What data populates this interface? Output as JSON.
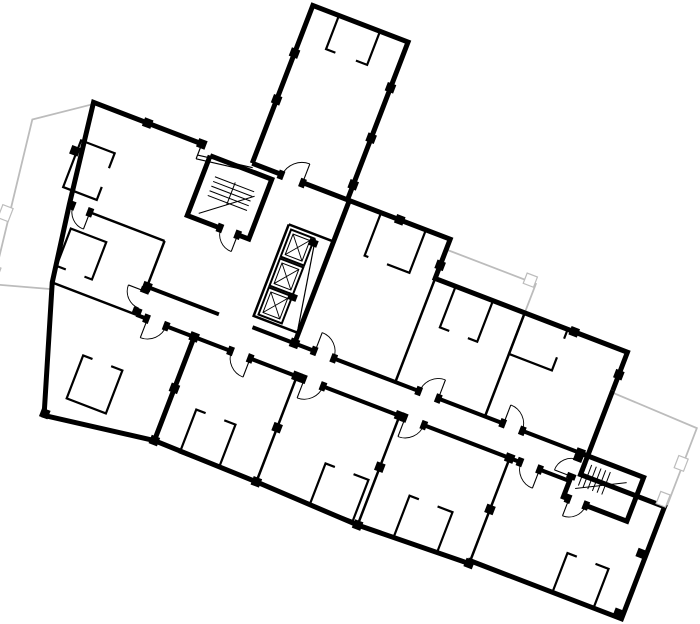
{
  "canvas": {
    "width": 700,
    "height": 624,
    "background": "#ffffff"
  },
  "palette": {
    "wall": "#000000",
    "terrace_line": "#bcbcbc",
    "floor": "#ffffff"
  },
  "plan": {
    "type": "architectural-floor-plan",
    "rotation_deg": 21,
    "stroke_layers": [
      {
        "name": "terrace-outlines",
        "color": "#bcbcbc",
        "width": 1.8,
        "paths": [
          "M124,64 L73,100 L95,268 L150,252",
          "M506,73 L602,73 L602,104",
          "M712,147 L804,150 L804,233 L712,235"
        ]
      },
      {
        "name": "exterior-walls",
        "color": "#000000",
        "width": 5,
        "paths": [
          "M294,62 L294,-107 L396,-107 L396,62",
          "M240,62 L124,62 L138,166 L150,245 L190,372 L302,356 L302,245",
          "M294,62 L396,62",
          "M396,62 L506,62 L506,104 L712,104 L712,145",
          "M302,356 L412,358 L522,362 L640,358 L640,355 L802,355 L802,235 L712,235 L712,145",
          "M398,62 L398,215",
          "M704,215 L772,215 L772,262 L704,262 L704,215",
          "M252,70 L318,70 L318,134 L252,134 L252,70"
        ]
      },
      {
        "name": "corridor-walls",
        "color": "#000000",
        "width": 4,
        "paths": [
          "M240,215 L318,215",
          "M352,215 L704,215",
          "M240,245 L704,245"
        ]
      },
      {
        "name": "partition-walls",
        "color": "#000000",
        "width": 2.5,
        "paths": [
          "M138,166 L240,166",
          "M240,166 L240,245",
          "M506,104 L506,215",
          "M602,104 L602,215",
          "M412,245 L412,358",
          "M522,245 L522,362",
          "M640,245 L640,358",
          "M150,245 L240,245",
          "M712,235 L802,235",
          "M350,106 L398,106",
          "M350,106 L350,204 L398,204"
        ]
      },
      {
        "name": "thin-lines",
        "color": "#000000",
        "width": 1.2,
        "paths": [
          "M240,62 L240,78",
          "M240,74 L296,66",
          "M240,78 L296,70",
          "M380,110 L396,200"
        ]
      }
    ],
    "closets": [
      {
        "rect": [
          126,
          102,
          36,
          50
        ],
        "gap": [
          158,
          118,
          8,
          20
        ]
      },
      {
        "rect": [
          148,
          188,
          38,
          40
        ],
        "gap": [
          158,
          224,
          20,
          8
        ]
      },
      {
        "rect": [
          205,
          302,
          42,
          46
        ],
        "gap": [
          215,
          298,
          20,
          8
        ]
      },
      {
        "rect": [
          322,
          -107,
          44,
          36
        ],
        "gap": [
          332,
          -75,
          22,
          8
        ]
      },
      {
        "rect": [
          432,
          62,
          48,
          46
        ],
        "gap": [
          436,
          104,
          20,
          8
        ]
      },
      {
        "rect": [
          528,
          104,
          40,
          44
        ],
        "gap": [
          538,
          144,
          20,
          8
        ]
      },
      {
        "rect": [
          602,
          104,
          46,
          44
        ],
        "gap": [
          644,
          114,
          8,
          20
        ]
      },
      {
        "rect": [
          330,
          312,
          42,
          46
        ],
        "gap": [
          340,
          308,
          20,
          8
        ]
      },
      {
        "rect": [
          470,
          316,
          46,
          44
        ],
        "gap": [
          480,
          312,
          20,
          8
        ]
      },
      {
        "rect": [
          560,
          316,
          46,
          44
        ],
        "gap": [
          570,
          312,
          20,
          8
        ]
      },
      {
        "rect": [
          728,
          313,
          44,
          42
        ],
        "gap": [
          738,
          309,
          20,
          8
        ]
      }
    ],
    "columns": [
      [
        182,
        62
      ],
      [
        240,
        62
      ],
      [
        294,
        -56
      ],
      [
        294,
        -6
      ],
      [
        396,
        -58
      ],
      [
        396,
        -4
      ],
      [
        396,
        46
      ],
      [
        452,
        62
      ],
      [
        506,
        90
      ],
      [
        655,
        104
      ],
      [
        712,
        128
      ],
      [
        124,
        114
      ],
      [
        190,
        370
      ],
      [
        240,
        215
      ],
      [
        302,
        245
      ],
      [
        302,
        300
      ],
      [
        302,
        356
      ],
      [
        398,
        215
      ],
      [
        412,
        245
      ],
      [
        412,
        300
      ],
      [
        412,
        358
      ],
      [
        522,
        245
      ],
      [
        522,
        300
      ],
      [
        522,
        362
      ],
      [
        640,
        245
      ],
      [
        640,
        300
      ],
      [
        640,
        358
      ],
      [
        704,
        215
      ],
      [
        797,
        287
      ],
      [
        797,
        351
      ]
    ],
    "elevator_shafts": [
      [
        354,
        110,
        25,
        29
      ],
      [
        354,
        141,
        25,
        29
      ],
      [
        354,
        172,
        25,
        29
      ]
    ],
    "elevator_blobs": [
      [
        375,
        111,
        9,
        7
      ],
      [
        375,
        169,
        9,
        7
      ]
    ],
    "stair_lines": [
      "M264,88 L306,88",
      "M264,93 L306,93",
      "M264,98 L306,98",
      "M264,103 L306,103",
      "M264,108 L306,108",
      "M285,86 L285,110",
      "M262,128 L308,92",
      "M714,222 L714,246",
      "M719,222 L719,246",
      "M724,222 L724,246",
      "M729,222 L729,246",
      "M734,222 L734,246",
      "M739,222 L739,246",
      "M712,234 L742,234",
      "M712,250 L758,226"
    ],
    "doors": [
      {
        "gap": [
          234,
          219,
          11,
          22
        ],
        "leaf": "M240,220 L222,220",
        "arc": "M222,220 A18,18 0 0,0 240,238"
      },
      {
        "gap": [
          251,
          240,
          21,
          10
        ],
        "leaf": "M252,245 L252,265",
        "arc": "M252,265 A20,20 0 0,0 272,245"
      },
      {
        "gap": [
          341,
          240,
          21,
          10
        ],
        "leaf": "M362,245 L362,265",
        "arc": "M362,265 A20,20 0 0,1 342,245"
      },
      {
        "gap": [
          419,
          240,
          21,
          10
        ],
        "leaf": "M420,245 L420,265",
        "arc": "M420,265 A20,20 0 0,0 440,245"
      },
      {
        "gap": [
          527,
          240,
          21,
          10
        ],
        "leaf": "M528,245 L528,265",
        "arc": "M528,265 A20,20 0 0,0 548,245"
      },
      {
        "gap": [
          651,
          240,
          21,
          10
        ],
        "leaf": "M672,245 L672,265",
        "arc": "M672,265 A20,20 0 0,1 652,245"
      },
      {
        "gap": [
          419,
          210,
          21,
          10
        ],
        "leaf": "M420,215 L420,195",
        "arc": "M420,195 A20,20 0 0,1 440,215"
      },
      {
        "gap": [
          531,
          210,
          21,
          10
        ],
        "leaf": "M552,215 L552,195",
        "arc": "M552,195 A20,20 0 0,0 532,215"
      },
      {
        "gap": [
          621,
          210,
          21,
          10
        ],
        "leaf": "M622,215 L622,195",
        "arc": "M622,195 A20,20 0 0,1 642,215"
      },
      {
        "gap": [
          325,
          58,
          23,
          9
        ],
        "leaf": "M348,62 L348,42",
        "arc": "M348,42 A22,22 0 0,0 326,62"
      },
      {
        "gap": [
          287,
          129,
          19,
          10
        ],
        "leaf": "M306,134 L306,152",
        "arc": "M306,152 A18,18 0 0,1 288,134"
      },
      {
        "gap": [
          699,
          221,
          10,
          19
        ],
        "leaf": "M704,240 L686,240",
        "arc": "M686,240 A18,18 0 0,1 704,222"
      },
      {
        "gap": [
          709,
          257,
          19,
          10
        ],
        "leaf": "M710,262 L710,280",
        "arc": "M710,280 A18,18 0 0,0 728,262"
      },
      {
        "gap": [
          317,
          210,
          36,
          10
        ],
        "leaf": null,
        "arc": null
      },
      {
        "gap": [
          141,
          161,
          19,
          10
        ],
        "leaf": "M160,166 L160,184",
        "arc": "M160,184 A18,18 0 0,1 142,166"
      }
    ],
    "terrace_notches": [
      [
        76,
        190,
        11,
        14
      ],
      [
        86,
        250,
        11,
        11
      ],
      [
        590,
        66,
        11,
        11
      ],
      [
        797,
        182,
        10,
        13
      ],
      [
        793,
        222,
        10,
        13
      ]
    ]
  }
}
